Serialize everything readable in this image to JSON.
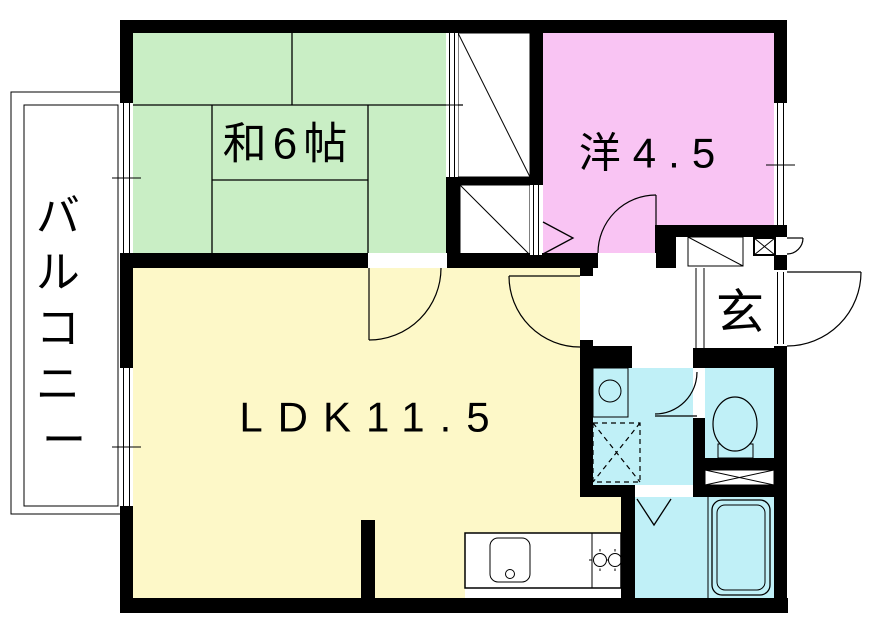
{
  "title": "apartment floor plan",
  "colors": {
    "japanese_room": "#c9eec5",
    "western_room": "#f9c4f3",
    "ldk": "#fdf8c8",
    "wet_area": "#c0f0f7",
    "closet": "#b9b9b9",
    "wall": "#000000",
    "background": "#ffffff"
  },
  "rooms": {
    "balcony": {
      "label": "バルコニー",
      "chars": [
        "バ",
        "ル",
        "コ",
        "ニ",
        "ー"
      ]
    },
    "japanese_room": {
      "label": "和6帖"
    },
    "western_room": {
      "label": "洋4.5"
    },
    "ldk": {
      "label": "LDK11.5"
    },
    "entrance": {
      "label": "玄"
    }
  },
  "fixtures": [
    "kitchen-counter",
    "kitchen-sink",
    "gas-stove-2-burner",
    "washbasin",
    "washing-machine-space",
    "toilet",
    "bathtub",
    "folding-bath-door",
    "shoe-cabinet",
    "pipe-space",
    "closet-upper",
    "closet-lower",
    "tatami-grid",
    "windows",
    "hinged-doors",
    "entrance-door"
  ]
}
